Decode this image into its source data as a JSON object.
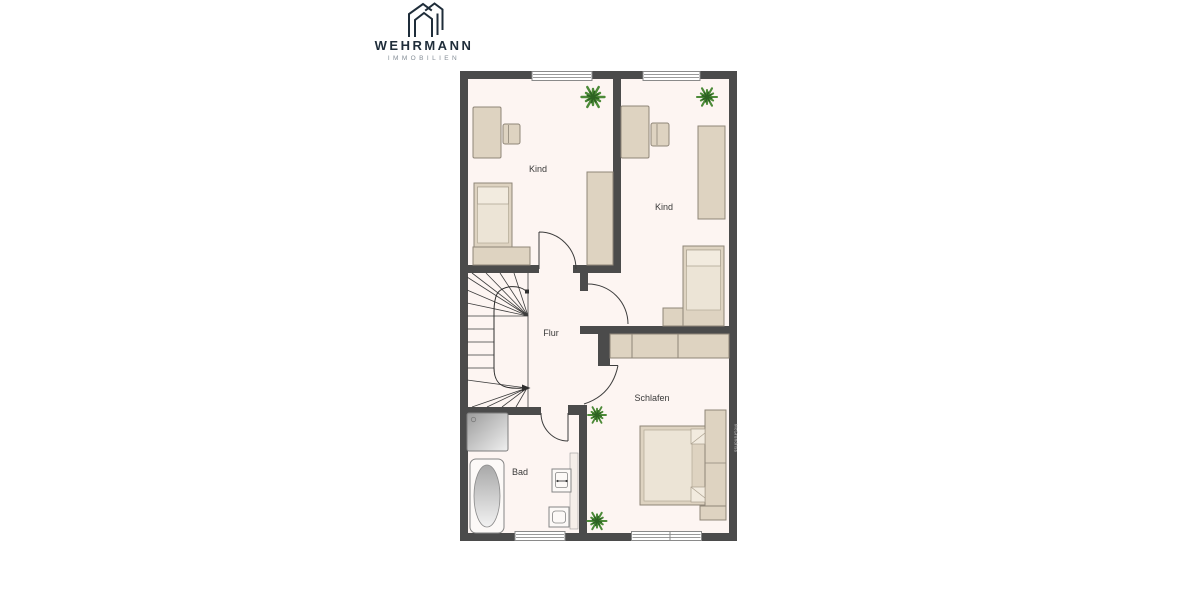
{
  "logo": {
    "title": "WEHRMANN",
    "subtitle": "IMMOBILIEN",
    "brand_color": "#1f2d3a",
    "subtitle_color": "#848d96"
  },
  "floorplan": {
    "rooms": {
      "kind_left": "Kind",
      "kind_right": "Kind",
      "flur": "Flur",
      "schlafen": "Schlafen",
      "bad": "Bad"
    },
    "watermark": "McGrundriss",
    "colors": {
      "wall": "#4b4b4b",
      "floor": "#fdf5f2",
      "furniture": "#ded3c1",
      "furniture_border": "#8f8678",
      "furniture_light": "#ece4d6",
      "fixture_white": "#fcf9f7",
      "line": "#3d3d3d",
      "plant_light": "#4c8a38",
      "plant_dark": "#2d6322"
    }
  }
}
